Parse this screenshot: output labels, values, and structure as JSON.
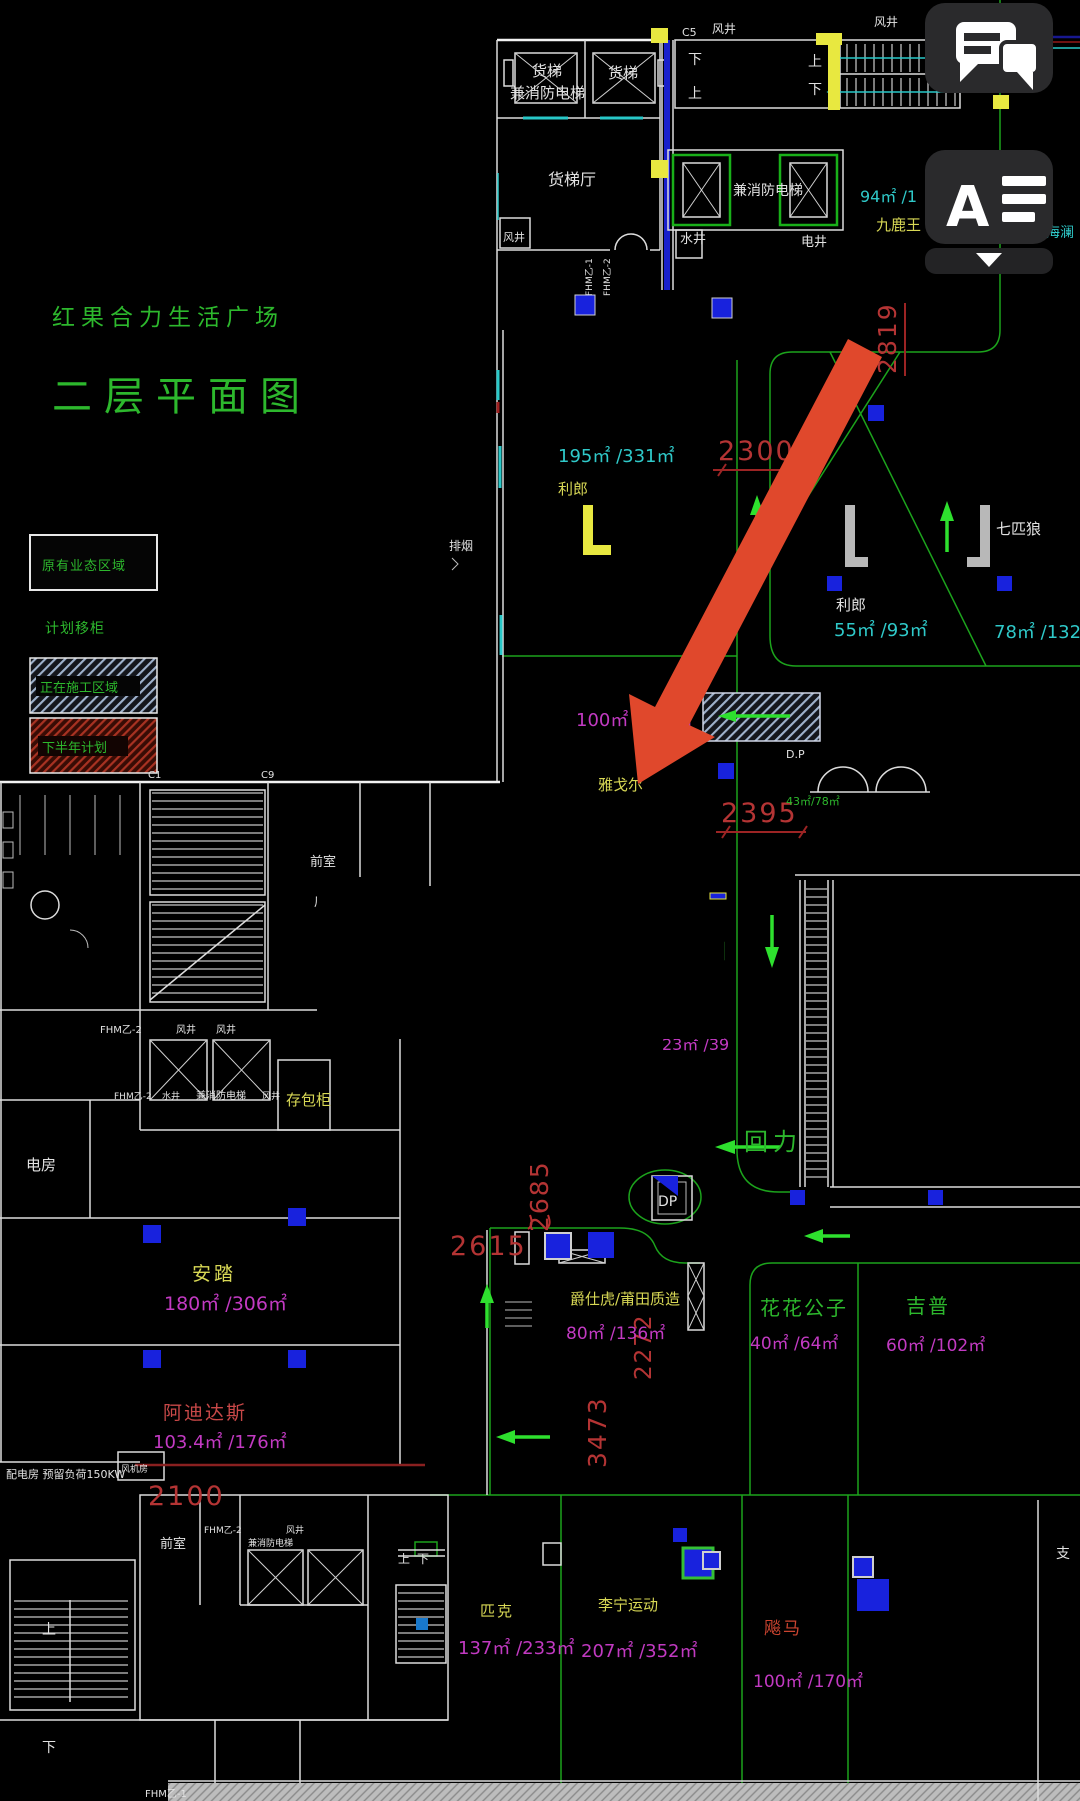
{
  "app": {
    "chat_button": {
      "icon": "chat-bubbles-icon"
    },
    "annotation_button": {
      "letter": "A",
      "icon": "text-annotation-icon"
    },
    "collapse_button": {
      "icon": "chevron-down-icon"
    }
  },
  "title": {
    "project": "红果合力生活广场",
    "drawing": "二层平面图"
  },
  "legend": {
    "existing_business": "原有业态区域",
    "planned_move": "计划移柜",
    "under_construction": "正在施工区域",
    "second_half_plan": "下半年计划"
  },
  "plan": {
    "freight": "货梯",
    "fire_elevator": "兼消防电梯",
    "freight_hall": "货梯厅",
    "wind_shaft": "风井",
    "water_shaft": "水井",
    "electric_shaft": "电井",
    "up": "上",
    "down": "下",
    "c5": "C5",
    "c1": "C1",
    "c9": "C9",
    "fhm1": "FHM乙-1",
    "fhm2": "FHM乙-2",
    "anteroom": "前室",
    "smoke_vent": "排烟",
    "locker": "存包柜",
    "electric_room": "电房",
    "power_note": "配电房  预留负荷150KW",
    "fan_room": "风机房",
    "dp": "D.P",
    "dp_short": "DP",
    "zhi": "支",
    "jiuluwang": "九鹿王",
    "area_94": "94㎡ /1",
    "hailan": "海澜",
    "lilang": "利郎",
    "area_195": "195㎡ /331㎡",
    "area_55": "55㎡ /93㎡",
    "qipilang": "七匹狼",
    "area_78": "78㎡ /132",
    "yageer": "雅戈尔",
    "area_100": "100㎡ /170㎡",
    "gedu": "格度佐致",
    "area_105": "105㎡ /178.5㎡",
    "huili": "回力",
    "area_23": "23㎡ /39",
    "area_43": "43㎡/78㎡",
    "anta": "安踏",
    "area_180": "180㎡ /306㎡",
    "adidas": "阿迪达斯",
    "area_103": "103.4㎡ /176㎡",
    "jueshihu": "爵仕虎/莆田质造",
    "area_80": "80㎡ /136㎡",
    "huahua": "花花公子",
    "area_40": "40㎡ /64㎡",
    "jeep": "吉普",
    "area_60": "60㎡ /102㎡",
    "peak": "匹克",
    "area_137": "137㎡ /233㎡",
    "lining": "李宁运动",
    "area_207": "207㎡ /352㎡",
    "biaoma": "飚马",
    "area_100b": "100㎡ /170㎡"
  },
  "dimensions": {
    "d2300": "2300",
    "d2395": "2395",
    "d2819": "2819",
    "d2685": "2685",
    "d2615": "2615",
    "d3473": "3473",
    "d2272": "2272",
    "d2100": "2100"
  },
  "colors": {
    "cad_green": "#2db82d",
    "cyan": "#2fc9c9",
    "magenta": "#c23ac2",
    "yellow": "#d8d855",
    "dim_red": "#b43434",
    "annotation_red": "#e0482c",
    "marker_blue": "#1822dd",
    "ui_button_bg": "#2a2a2c"
  }
}
